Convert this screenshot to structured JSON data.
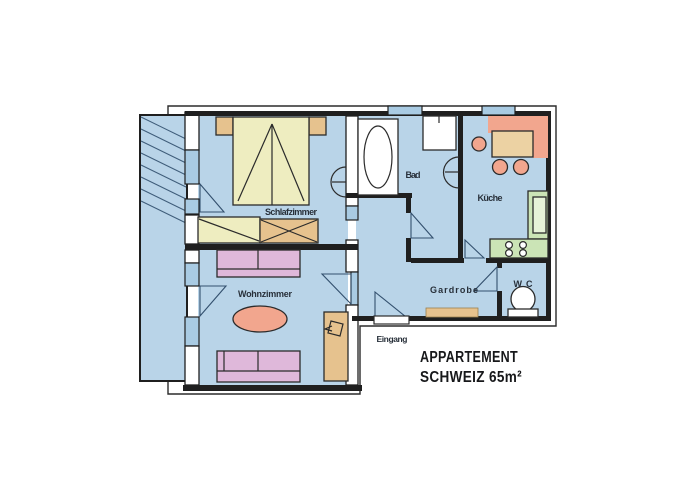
{
  "plan": {
    "title_line1": "APPARTEMENT",
    "title_line2": "SCHWEIZ 65m²",
    "rooms": {
      "bedroom": "Schlafzimmer",
      "living_room": "Wohnzimmer",
      "bathroom": "Bad",
      "kitchen": "Küche",
      "hallway": "Gardrobe",
      "wc": "WC",
      "entrance": "Eingang"
    }
  },
  "colors": {
    "floor": "#b9d4e8",
    "wall": "#1f1f1f",
    "window": "#a9cbe3",
    "hatch": "#3f5d7a",
    "bed_yellow": "#eeedc0",
    "wood_tan": "#e6c28e",
    "wood_light": "#ecd2a3",
    "sofa_pink": "#dfb8da",
    "accent_salmon": "#f2a68e",
    "counter_green": "#cbe4b6",
    "counter_light": "#e6f2d8",
    "door_swing": "#33506e",
    "label": "#28303a",
    "title": "#17181a",
    "outline": "#2b2b2b"
  }
}
